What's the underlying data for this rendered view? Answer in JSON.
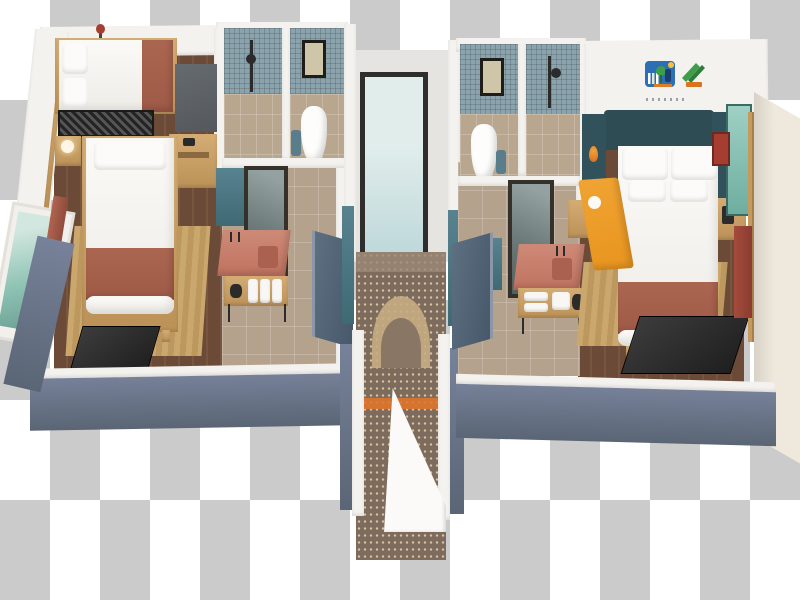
{
  "background": {
    "pattern": "transparency-checkerboard",
    "tile_width_px": 50,
    "tile_height_px": 100
  },
  "palette": {
    "checker-light": "#ffffff",
    "checker-dark": "#cbcbcb",
    "wall-white": "#f4f2ef",
    "wall-slate": "#77829a",
    "wall-slate-dark": "#5a6575",
    "floor-wood": "#6b4b37",
    "floor-wood-light": "#78553f",
    "tile-beige": "#b4a28d",
    "tile-blue": "#8ba3ac",
    "rug-tan": "#caa76c",
    "rug-tan-dark": "#bc985e",
    "bed-white": "#eeece7",
    "terracotta": "#9e5a46",
    "headboard-teal": "#2e4c54",
    "vanity-pink": "#c07260",
    "teal-glass": "#8fc3b4",
    "corridor-glass": "#bfd8da",
    "carpet-brown": "#7d6b5e",
    "carpet-cream": "#d8c59e",
    "orange-accent": "#e8941f",
    "orange-stripe": "#df762b",
    "tv-black": "#1f1f1f",
    "wood-furniture": "#bb9157",
    "red-accent": "#a53e30",
    "door-slate": "#46586a",
    "logo-blue": "#2e6eb4",
    "logo-green": "#3e9d49",
    "logo-yellow": "#f2c238",
    "logo-orange": "#e07b28"
  },
  "units": {
    "left_room": {
      "items": [
        "double-bed",
        "pillows",
        "terracotta-runner",
        "luggage-bench",
        "folded-bunk-frame",
        "desk",
        "telephone",
        "nightstand",
        "reading-lamp",
        "single-bed",
        "terracotta-blanket",
        "area-rug",
        "wall-tv",
        "teal-picture-window",
        "curtain",
        "wall-sconce-red",
        "shower",
        "shower-fixture",
        "toilet",
        "toilet-artwork",
        "waste-bin",
        "vanity-mirror",
        "vanity-counter",
        "sink",
        "towel-rolls",
        "kettle-tray",
        "entry-door"
      ]
    },
    "corridor": {
      "items": [
        "end-glass-window",
        "patterned-carpet",
        "arch-motif",
        "orange-stripe",
        "door-jambs",
        "open-white-door"
      ]
    },
    "right_room": {
      "items": [
        "shower",
        "shower-fixture",
        "toilet",
        "toilet-artwork",
        "waste-bin",
        "vanity-mirror",
        "vanity-counter",
        "sink",
        "towels",
        "kettle-tray",
        "entry-door",
        "headboard",
        "side-panels",
        "orange-wall-sconces",
        "nightstands",
        "double-bed",
        "pillows",
        "terracotta-blanket",
        "area-rug",
        "wall-tv",
        "orange-lounge-chair",
        "teal-glass-panel",
        "slatted-wardrobe",
        "red-curtain",
        "red-wall-art",
        "brand-logo"
      ]
    }
  },
  "logo": {
    "name": "resort-brand-logo",
    "colors": [
      "#2e6eb4",
      "#3e9d49",
      "#f2c238",
      "#e07b28"
    ]
  }
}
